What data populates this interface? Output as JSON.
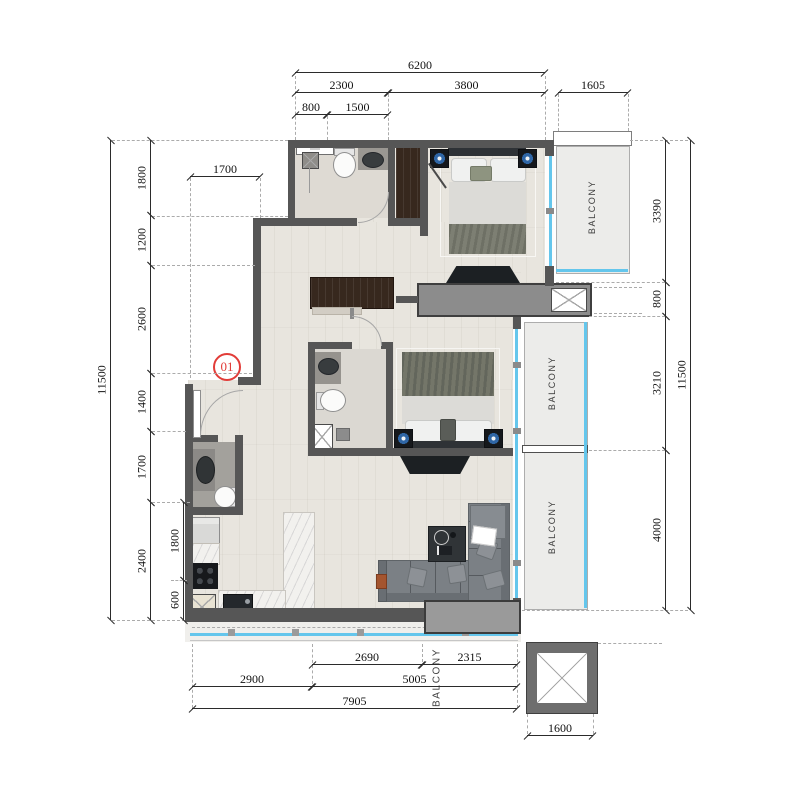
{
  "drawing": {
    "type": "apartment floor plan",
    "unit_marker": "01"
  },
  "labels": {
    "balcony_top_right": "BALCONY",
    "balcony_middle_right": "BALCONY",
    "balcony_lower_right": "BALCONY",
    "balcony_bottom": "BALCONY"
  },
  "dims": {
    "top": [
      "6200",
      "2300",
      "3800",
      "1605",
      "800",
      "1500",
      "1700"
    ],
    "left": [
      "11500",
      "1800",
      "1200",
      "2600",
      "1400",
      "1700",
      "2400",
      "1800",
      "600"
    ],
    "right": [
      "3390",
      "800",
      "3210",
      "4000",
      "11500"
    ],
    "bottom": [
      "2690",
      "2315",
      "2900",
      "5005",
      "7905",
      "1600"
    ]
  },
  "colors": {
    "wall": "#565656",
    "glazing": "#64c6ec",
    "floor": "#e8e5de",
    "balcony_fill": "#ececea",
    "marker_red": "#e23c38"
  }
}
